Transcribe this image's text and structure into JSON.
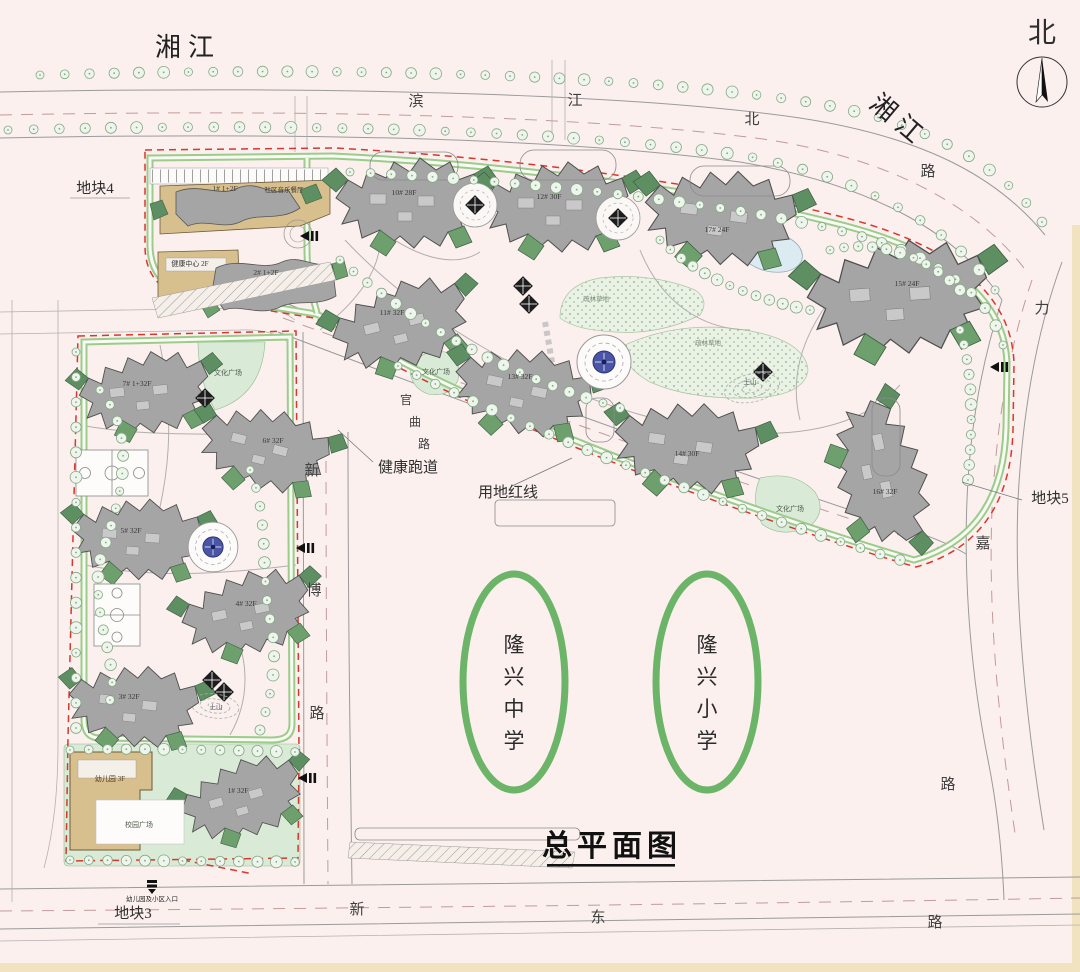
{
  "title": "总平面图",
  "compass_label": "北",
  "river_label_left": "湘江",
  "river_label_right": "湘江",
  "plot_labels": {
    "p3": "地块3",
    "p4": "地块4",
    "p5": "地块5"
  },
  "road_labels": {
    "binjiang": [
      "滨",
      "江",
      "北",
      "路"
    ],
    "lijia": [
      "力",
      "嘉",
      "路"
    ],
    "xinbo": [
      "新",
      "博",
      "路"
    ],
    "xindong": [
      "新",
      "东",
      "路"
    ],
    "guanqu": [
      "官",
      "曲",
      "路"
    ]
  },
  "school_labels": {
    "middle": [
      "隆",
      "兴",
      "中",
      "学"
    ],
    "primary": [
      "隆",
      "兴",
      "小",
      "学"
    ]
  },
  "site_labels": {
    "health_track": "健康跑道",
    "red_line": "用地红线",
    "kindergarten_entrance": "幼儿园及小区入口",
    "community_restaurant": "社区音乐餐厅",
    "health_center": "健康中心 2F",
    "kindergarten": "幼儿园 3F",
    "campus_plaza": "校园广场",
    "culture_plaza_1": "文化广场",
    "culture_plaza_2": "文化广场",
    "culture_plaza_3": "文化广场",
    "earth_hill_1": "土山",
    "earth_hill_2": "土山",
    "lawn_1": "疏林草地",
    "lawn_2": "疏林草地"
  },
  "buildings": [
    {
      "label": "1# 1+2F"
    },
    {
      "label": "2# 1+2F"
    },
    {
      "label": "10# 28F"
    },
    {
      "label": "12# 30F"
    },
    {
      "label": "17# 24F"
    },
    {
      "label": "15# 24F"
    },
    {
      "label": "11# 32F"
    },
    {
      "label": "13# 32F"
    },
    {
      "label": "14# 30F"
    },
    {
      "label": "16# 32F"
    },
    {
      "label": "7# 1+32F"
    },
    {
      "label": "6# 32F"
    },
    {
      "label": "5# 32F"
    },
    {
      "label": "4# 32F"
    },
    {
      "label": "3# 32F"
    },
    {
      "label": "1# 32F"
    }
  ],
  "colors": {
    "background": "#fbf0ee",
    "track_green": "#9ccb8b",
    "red_line": "#d9372c",
    "building_grey": "#a5a5a5",
    "roof_green": "#5e8f63",
    "podium_tan": "#d8bf8e",
    "lawn_green": "#d9ead6",
    "school_ellipse_green": "#6cb468"
  }
}
